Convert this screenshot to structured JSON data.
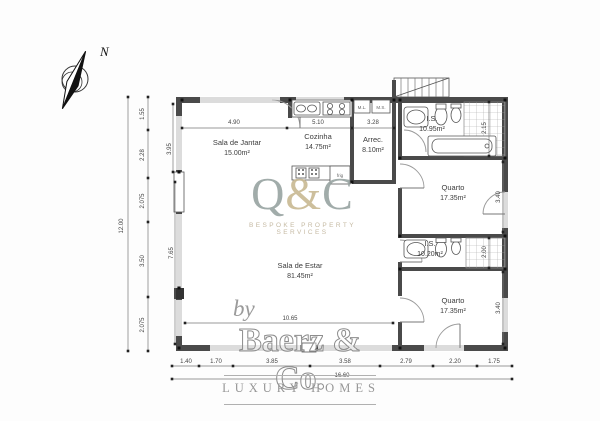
{
  "compass": {
    "label": "N"
  },
  "rooms": [
    {
      "name": "Sala de Jantar",
      "area": "15.00m²",
      "x": 237,
      "y": 145
    },
    {
      "name": "Cozinha",
      "area": "14.75m²",
      "x": 318,
      "y": 139
    },
    {
      "name": "Arrec.",
      "area": "8.10m²",
      "x": 373,
      "y": 142
    },
    {
      "name": "I.S.",
      "area": "10.95m²",
      "x": 432,
      "y": 121
    },
    {
      "name": "Quarto",
      "area": "17.35m²",
      "x": 453,
      "y": 190
    },
    {
      "name": "I.S.",
      "area": "10.20m²",
      "x": 430,
      "y": 246
    },
    {
      "name": "Quarto",
      "area": "17.35m²",
      "x": 453,
      "y": 303
    },
    {
      "name": "Sala de Estar",
      "area": "81.45m²",
      "x": 300,
      "y": 268
    }
  ],
  "appliance_labels": [
    {
      "t": "M.L.",
      "x": 362,
      "y": 109
    },
    {
      "t": "M.S.",
      "x": 381,
      "y": 109
    },
    {
      "t": "frig",
      "x": 340,
      "y": 177
    }
  ],
  "dim_labels": [
    {
      "t": "12.00",
      "x": 123,
      "y": 226,
      "r": -90
    },
    {
      "t": "1.55",
      "x": 144,
      "y": 114,
      "r": -90
    },
    {
      "t": "2.28",
      "x": 144,
      "y": 155,
      "r": -90
    },
    {
      "t": "2.075",
      "x": 144,
      "y": 201,
      "r": -90
    },
    {
      "t": "3.50",
      "x": 144,
      "y": 261,
      "r": -90
    },
    {
      "t": "2.075",
      "x": 144,
      "y": 325,
      "r": -90
    },
    {
      "t": "3.95",
      "x": 171,
      "y": 149,
      "r": -90
    },
    {
      "t": "7.65",
      "x": 173,
      "y": 253,
      "r": -90
    },
    {
      "t": "4.90",
      "x": 234,
      "y": 124,
      "r": 0
    },
    {
      "t": "5.10",
      "x": 318,
      "y": 124,
      "r": 0
    },
    {
      "t": "3.28",
      "x": 373,
      "y": 124,
      "r": 0
    },
    {
      "t": "2.15",
      "x": 486,
      "y": 128,
      "r": -90
    },
    {
      "t": "3.40",
      "x": 500,
      "y": 197,
      "r": -90
    },
    {
      "t": "2.00",
      "x": 486,
      "y": 252,
      "r": -90
    },
    {
      "t": "3.40",
      "x": 500,
      "y": 308,
      "r": -90
    },
    {
      "t": "10.65",
      "x": 290,
      "y": 320,
      "r": 0
    },
    {
      "t": "1.40",
      "x": 186,
      "y": 363,
      "r": 0
    },
    {
      "t": "1.70",
      "x": 216,
      "y": 363,
      "r": 0
    },
    {
      "t": "3.85",
      "x": 272,
      "y": 363,
      "r": 0
    },
    {
      "t": "3.58",
      "x": 345,
      "y": 363,
      "r": 0
    },
    {
      "t": "2.79",
      "x": 406,
      "y": 363,
      "r": 0
    },
    {
      "t": "2.20",
      "x": 455,
      "y": 363,
      "r": 0
    },
    {
      "t": "1.75",
      "x": 494,
      "y": 363,
      "r": 0
    },
    {
      "t": "16.60",
      "x": 342,
      "y": 377,
      "r": 0
    }
  ],
  "watermark": {
    "q": "Q",
    "amp": "&",
    "c": "C",
    "subtitle": "BESPOKE PROPERTY SERVICES",
    "q_color": "#9aa5a3",
    "amp_color": "#c9ba94"
  },
  "branding": {
    "by": "by",
    "name": "Baerz & Co.",
    "tagline": "LUXURY HOMES"
  }
}
